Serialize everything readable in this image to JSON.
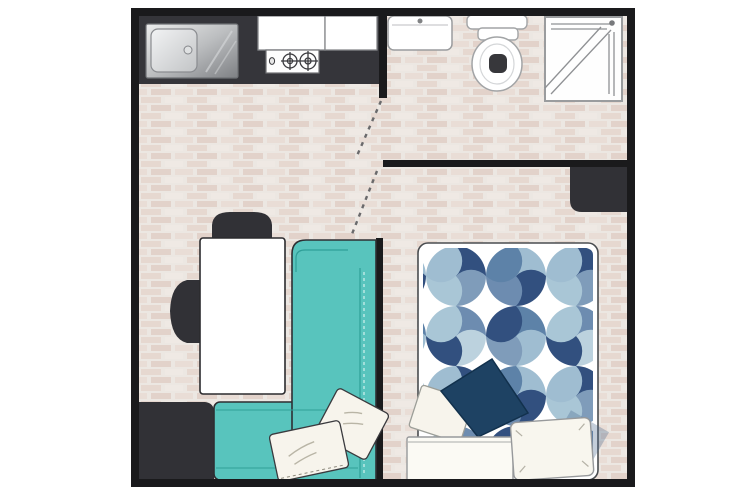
{
  "page": {
    "background": "#ffffff",
    "image_type": "studio-apartment-floor-plan"
  },
  "colors": {
    "wall": "#1a1a1c",
    "counter": "#35353a",
    "furniture_dark": "#313136",
    "sofa": "#58c4bd",
    "sofa_seam": "#2f9f98",
    "floor_base": "#ece7e2",
    "brick_a": "#e6d8d0",
    "brick_b": "#efe9e4",
    "brick_c": "#e2d2ca",
    "table": "#ffffff",
    "pillow_navy": "#1e4263",
    "pillow_cream": "#f7f4ec",
    "fixture_fill": "#ffffff",
    "fixture_stroke": "#9a9c9e",
    "duvet": {
      "navy": "#32507f",
      "slate": "#6d8cb0",
      "steel": "#5d82a8",
      "mid": "#7f9cba",
      "light": "#9fbdd1",
      "pale": "#a9c6d6",
      "paler": "#bcd2de"
    }
  },
  "plan": {
    "rooms": [
      {
        "name": "kitchen",
        "items": [
          "counter",
          "sink",
          "cooktop",
          "cabinets"
        ]
      },
      {
        "name": "bathroom",
        "items": [
          "washbasin",
          "toilet",
          "shower"
        ]
      },
      {
        "name": "living-area",
        "items": [
          "table",
          "chair",
          "chair",
          "sofa",
          "chaise",
          "cushion",
          "cushion",
          "storage-block"
        ]
      },
      {
        "name": "bedroom",
        "items": [
          "double-bed",
          "patterned-duvet",
          "closet",
          "white-pillow",
          "white-pillow",
          "navy-accent-pillow"
        ]
      }
    ],
    "doors": [
      "bathroom-door-swing",
      "bedroom-door-swing"
    ]
  }
}
